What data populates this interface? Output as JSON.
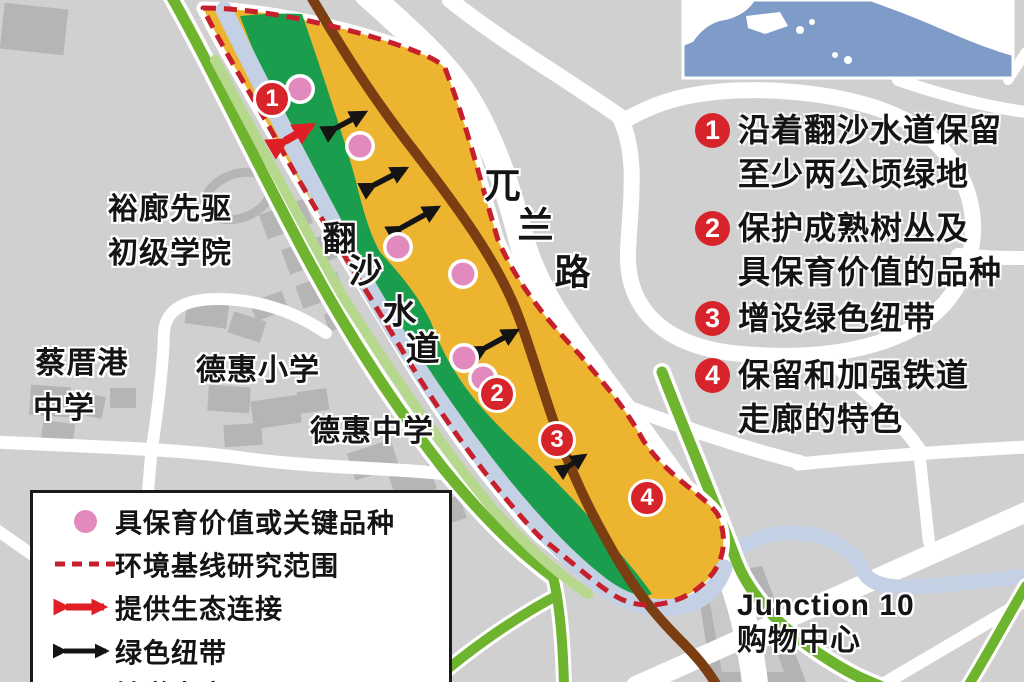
{
  "colors": {
    "bg": "#d0d0d0",
    "building": "#b5b5b5",
    "road-white": "#ffffff",
    "road-green": "#6eb42e",
    "corridor-yellow": "#edb52f",
    "veg-green": "#1a9e4d",
    "canal-blue": "#c4d0e4",
    "bank-green": "#b6d88c",
    "rail-brown": "#7b3d12",
    "boundary-red": "#c5202b",
    "marker-red": "#d7232a",
    "species-pink": "#e289bd",
    "arrow-black": "#141414",
    "arrow-red": "#e01f25",
    "inset-water": "#7e9cc7",
    "inset-land": "#ffffff",
    "text": "#141414"
  },
  "annotations": [
    {
      "num": "1",
      "line1": "沿着翻沙水道保留",
      "line2": "至少两公顷绿地"
    },
    {
      "num": "2",
      "line1": "保护成熟树丛及",
      "line2": "具保育价值的品种"
    },
    {
      "num": "3",
      "line1": "增设绿色纽带",
      "line2": ""
    },
    {
      "num": "4",
      "line1": "保留和加强铁道",
      "line2": "走廊的特色"
    }
  ],
  "legend": {
    "items": [
      {
        "label": "具保育价值或关键品种"
      },
      {
        "label": "环境基线研究范围"
      },
      {
        "label": "提供生态连接"
      },
      {
        "label": "绿色纽带"
      },
      {
        "label": "铁道走廊"
      }
    ]
  },
  "markers": [
    {
      "num": "1"
    },
    {
      "num": "2"
    },
    {
      "num": "3"
    },
    {
      "num": "4"
    }
  ],
  "labels": {
    "jc1": "裕廊先驱",
    "jc2": "初级学院",
    "cck1": "蔡厝港",
    "cck2": "中学",
    "primary": "德惠小学",
    "secondary": "德惠中学",
    "junction1": "Junction 10",
    "junction2": "购物中心",
    "road": {
      "c1": "兀",
      "c2": "兰",
      "c3": "路"
    },
    "canal": {
      "c1": "翻",
      "c2": "沙",
      "c3": "水",
      "c4": "道"
    }
  }
}
